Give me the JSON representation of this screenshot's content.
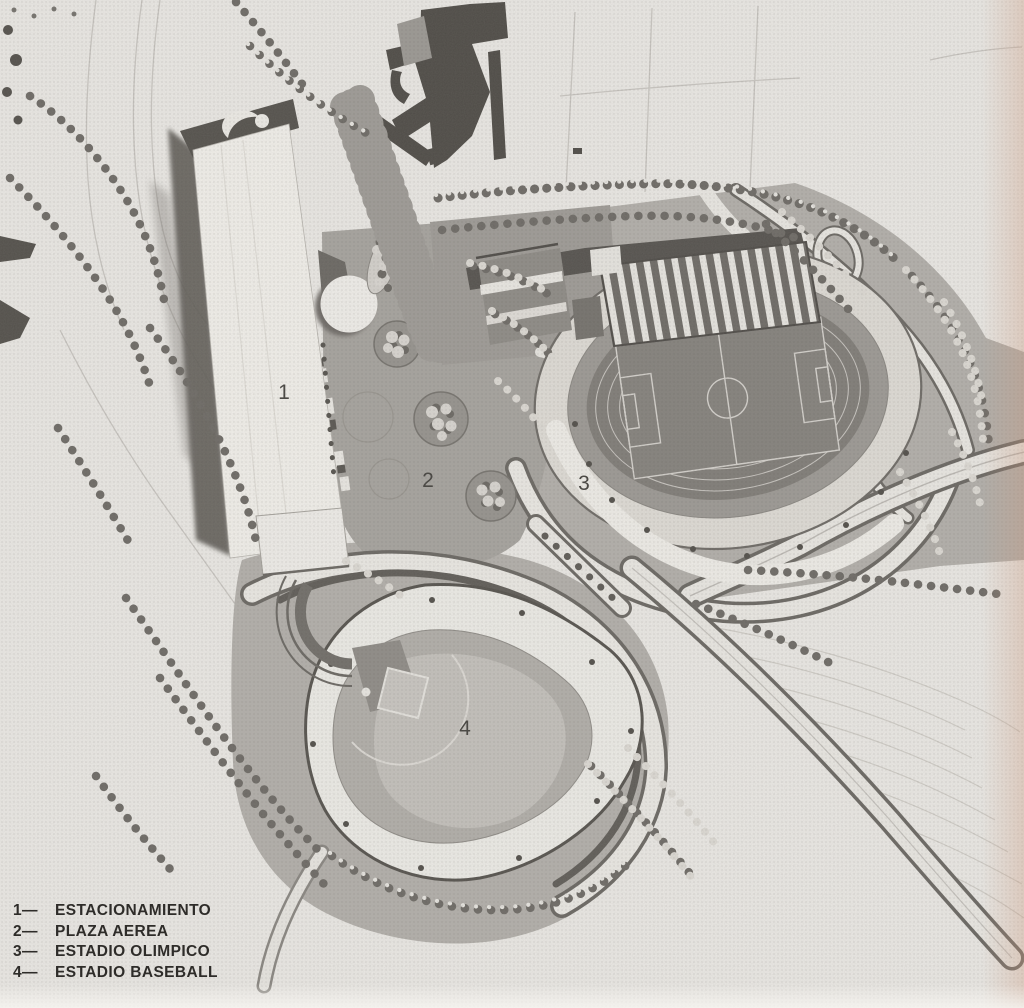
{
  "plan": {
    "markers": [
      {
        "number": "1",
        "refers_to": "estacionamiento"
      },
      {
        "number": "2",
        "refers_to": "plaza-aerea"
      },
      {
        "number": "3",
        "refers_to": "estadio-olimpico"
      },
      {
        "number": "4",
        "refers_to": "estadio-baseball"
      }
    ]
  },
  "legend": {
    "items": [
      {
        "prefix": "1—",
        "label": "ESTACIONAMIENTO"
      },
      {
        "prefix": "2—",
        "label": "PLAZA AEREA"
      },
      {
        "prefix": "3—",
        "label": "ESTADIO OLIMPICO"
      },
      {
        "prefix": "4—",
        "label": "ESTADIO BASEBALL"
      }
    ]
  },
  "colors": {
    "paper": "#eae8e4",
    "ground_gray": "#b2afaa",
    "plaza_gray": "#a6a39e",
    "track_dark": "#807d78",
    "white_surface": "#eceae5",
    "ink_dark": "#4f4c47",
    "legend_text": "#2e2c29"
  }
}
